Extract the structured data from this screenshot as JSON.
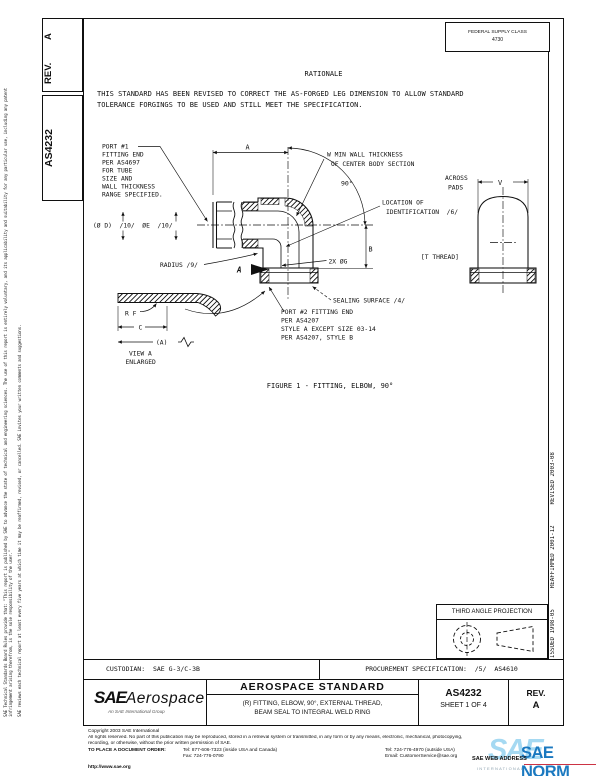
{
  "doc": {
    "rev_label": "REV.",
    "rev_value": "A",
    "number": "AS4232",
    "fsc_line1": "FEDERAL SUPPLY CLASS",
    "fsc_value": "4730",
    "dates_vertical": "ISSUED 1998-05      REAFFIRMED 2001-12      REVISED 2003-08",
    "left_note_1": "SAE Technical Standards Board Rules provide that: \"This report is published by SAE to advance the state of technical and engineering sciences. The use of this report is entirely voluntary, and its applicability and suitability for any particular use, including any patent infringement arising therefrom, is the sole responsibility of the user.\"",
    "left_note_2": "SAE reviews each technical report at least every five years at which time it may be reaffirmed, revised, or cancelled. SAE invites your written comments and suggestions."
  },
  "rationale": {
    "heading": "RATIONALE",
    "line1": "THIS STANDARD HAS BEEN REVISED TO CORRECT THE AS-FORGED LEG DIMENSION TO ALLOW STANDARD",
    "line2": "TOLERANCE FORGINGS TO BE USED AND STILL MEET THE SPECIFICATION."
  },
  "figure": {
    "caption": "FIGURE 1 - FITTING, ELBOW, 90°",
    "labels": {
      "port1": [
        "PORT #1",
        "FITTING END",
        "PER AS4697",
        "FOR TUBE",
        "SIZE AND",
        "WALL THICKNESS",
        "RANGE SPECIFIED."
      ],
      "dia": "(Ø D)  /10/  ØE  /10/",
      "wall": [
        "W MIN WALL THICKNESS",
        "OF CENTER BODY SECTION"
      ],
      "dim_a": "A",
      "angle": "90°",
      "loc": [
        "LOCATION OF",
        "IDENTIFICATION  /6/"
      ],
      "across": [
        "ACROSS",
        "PADS"
      ],
      "dim_v": "V",
      "thread": "[T THREAD]",
      "dim_b": "B",
      "radius": "RADIUS /9/",
      "view_arrow": "A",
      "holes": "2X ØG",
      "sealing": "SEALING SURFACE /4/",
      "port2": [
        "PORT #2 FITTING END",
        "PER AS4207",
        "STYLE A EXCEPT SIZE 03-14",
        "PER AS4207, STYLE B"
      ],
      "rf": "R F",
      "dim_c": "C",
      "dim_a_ref": "(A)",
      "view_a": [
        "VIEW A",
        "ENLARGED"
      ]
    }
  },
  "projection": {
    "heading": "THIRD ANGLE PROJECTION"
  },
  "admin": {
    "custodian": "CUSTODIAN:  SAE G-3/C-3B",
    "procurement": "PROCUREMENT SPECIFICATION:  /5/  AS4610"
  },
  "title_block": {
    "org": "SAE",
    "org2": "Aerospace",
    "org_sub": "An SAE International Group",
    "kind": "AEROSPACE STANDARD",
    "title_line1": "(R) FITTING, ELBOW, 90°, EXTERNAL THREAD,",
    "title_line2": "BEAM SEAL TO INTEGRAL WELD RING",
    "number": "AS4232",
    "sheet": "SHEET 1 OF 4",
    "rev_label": "REV.",
    "rev_value": "A"
  },
  "footer": {
    "copyright": "Copyright 2003 SAE International",
    "rights1": "All rights reserved. No part of this publication may be reproduced, stored in a retrieval system or transmitted, in any form or by any means, electronic, mechanical, photocopying,",
    "rights2": "recording, or otherwise, without the prior written permission of SAE.",
    "order_label": "TO PLACE A DOCUMENT ORDER:",
    "tel1": "Tel:  877-606-7323 (inside USA and Canada)",
    "tel2": "Tel:  724-776-4970 (outside USA)",
    "fax": "Fax:  724-776-0790",
    "email": "Email:  CustomerService@sae.org",
    "web": "http://www.sae.org",
    "web_label": "SAE WEB ADDRESS"
  },
  "watermark": {
    "sae": "SAE",
    "norm": "SAE NORM",
    "sub": "INTERNATIONAL"
  },
  "colors": {
    "line": "#101010",
    "wm_light": "#a5d9f2",
    "wm_dark": "#1b79c0",
    "wm_red": "#cc3344"
  }
}
